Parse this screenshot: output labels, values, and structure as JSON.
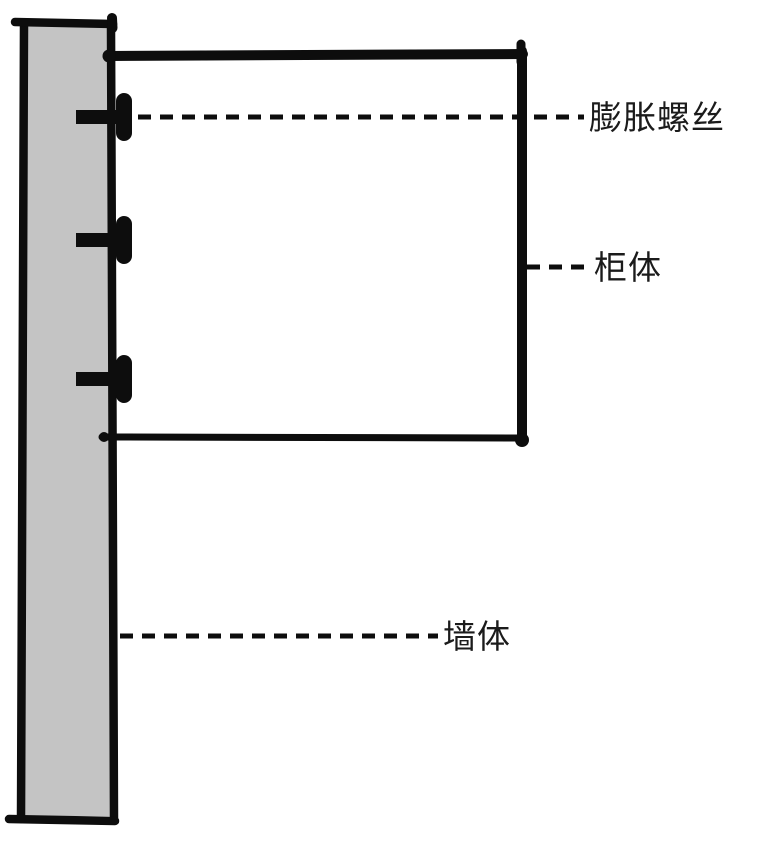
{
  "colors": {
    "background": "#ffffff",
    "ink": "#0d0d0d",
    "wall_fill": "#c4c4c4",
    "label_text": "#1b1b1b"
  },
  "labels": {
    "expansion_screw": "膨胀螺丝",
    "cabinet": "柜体",
    "wall": "墙体"
  }
}
